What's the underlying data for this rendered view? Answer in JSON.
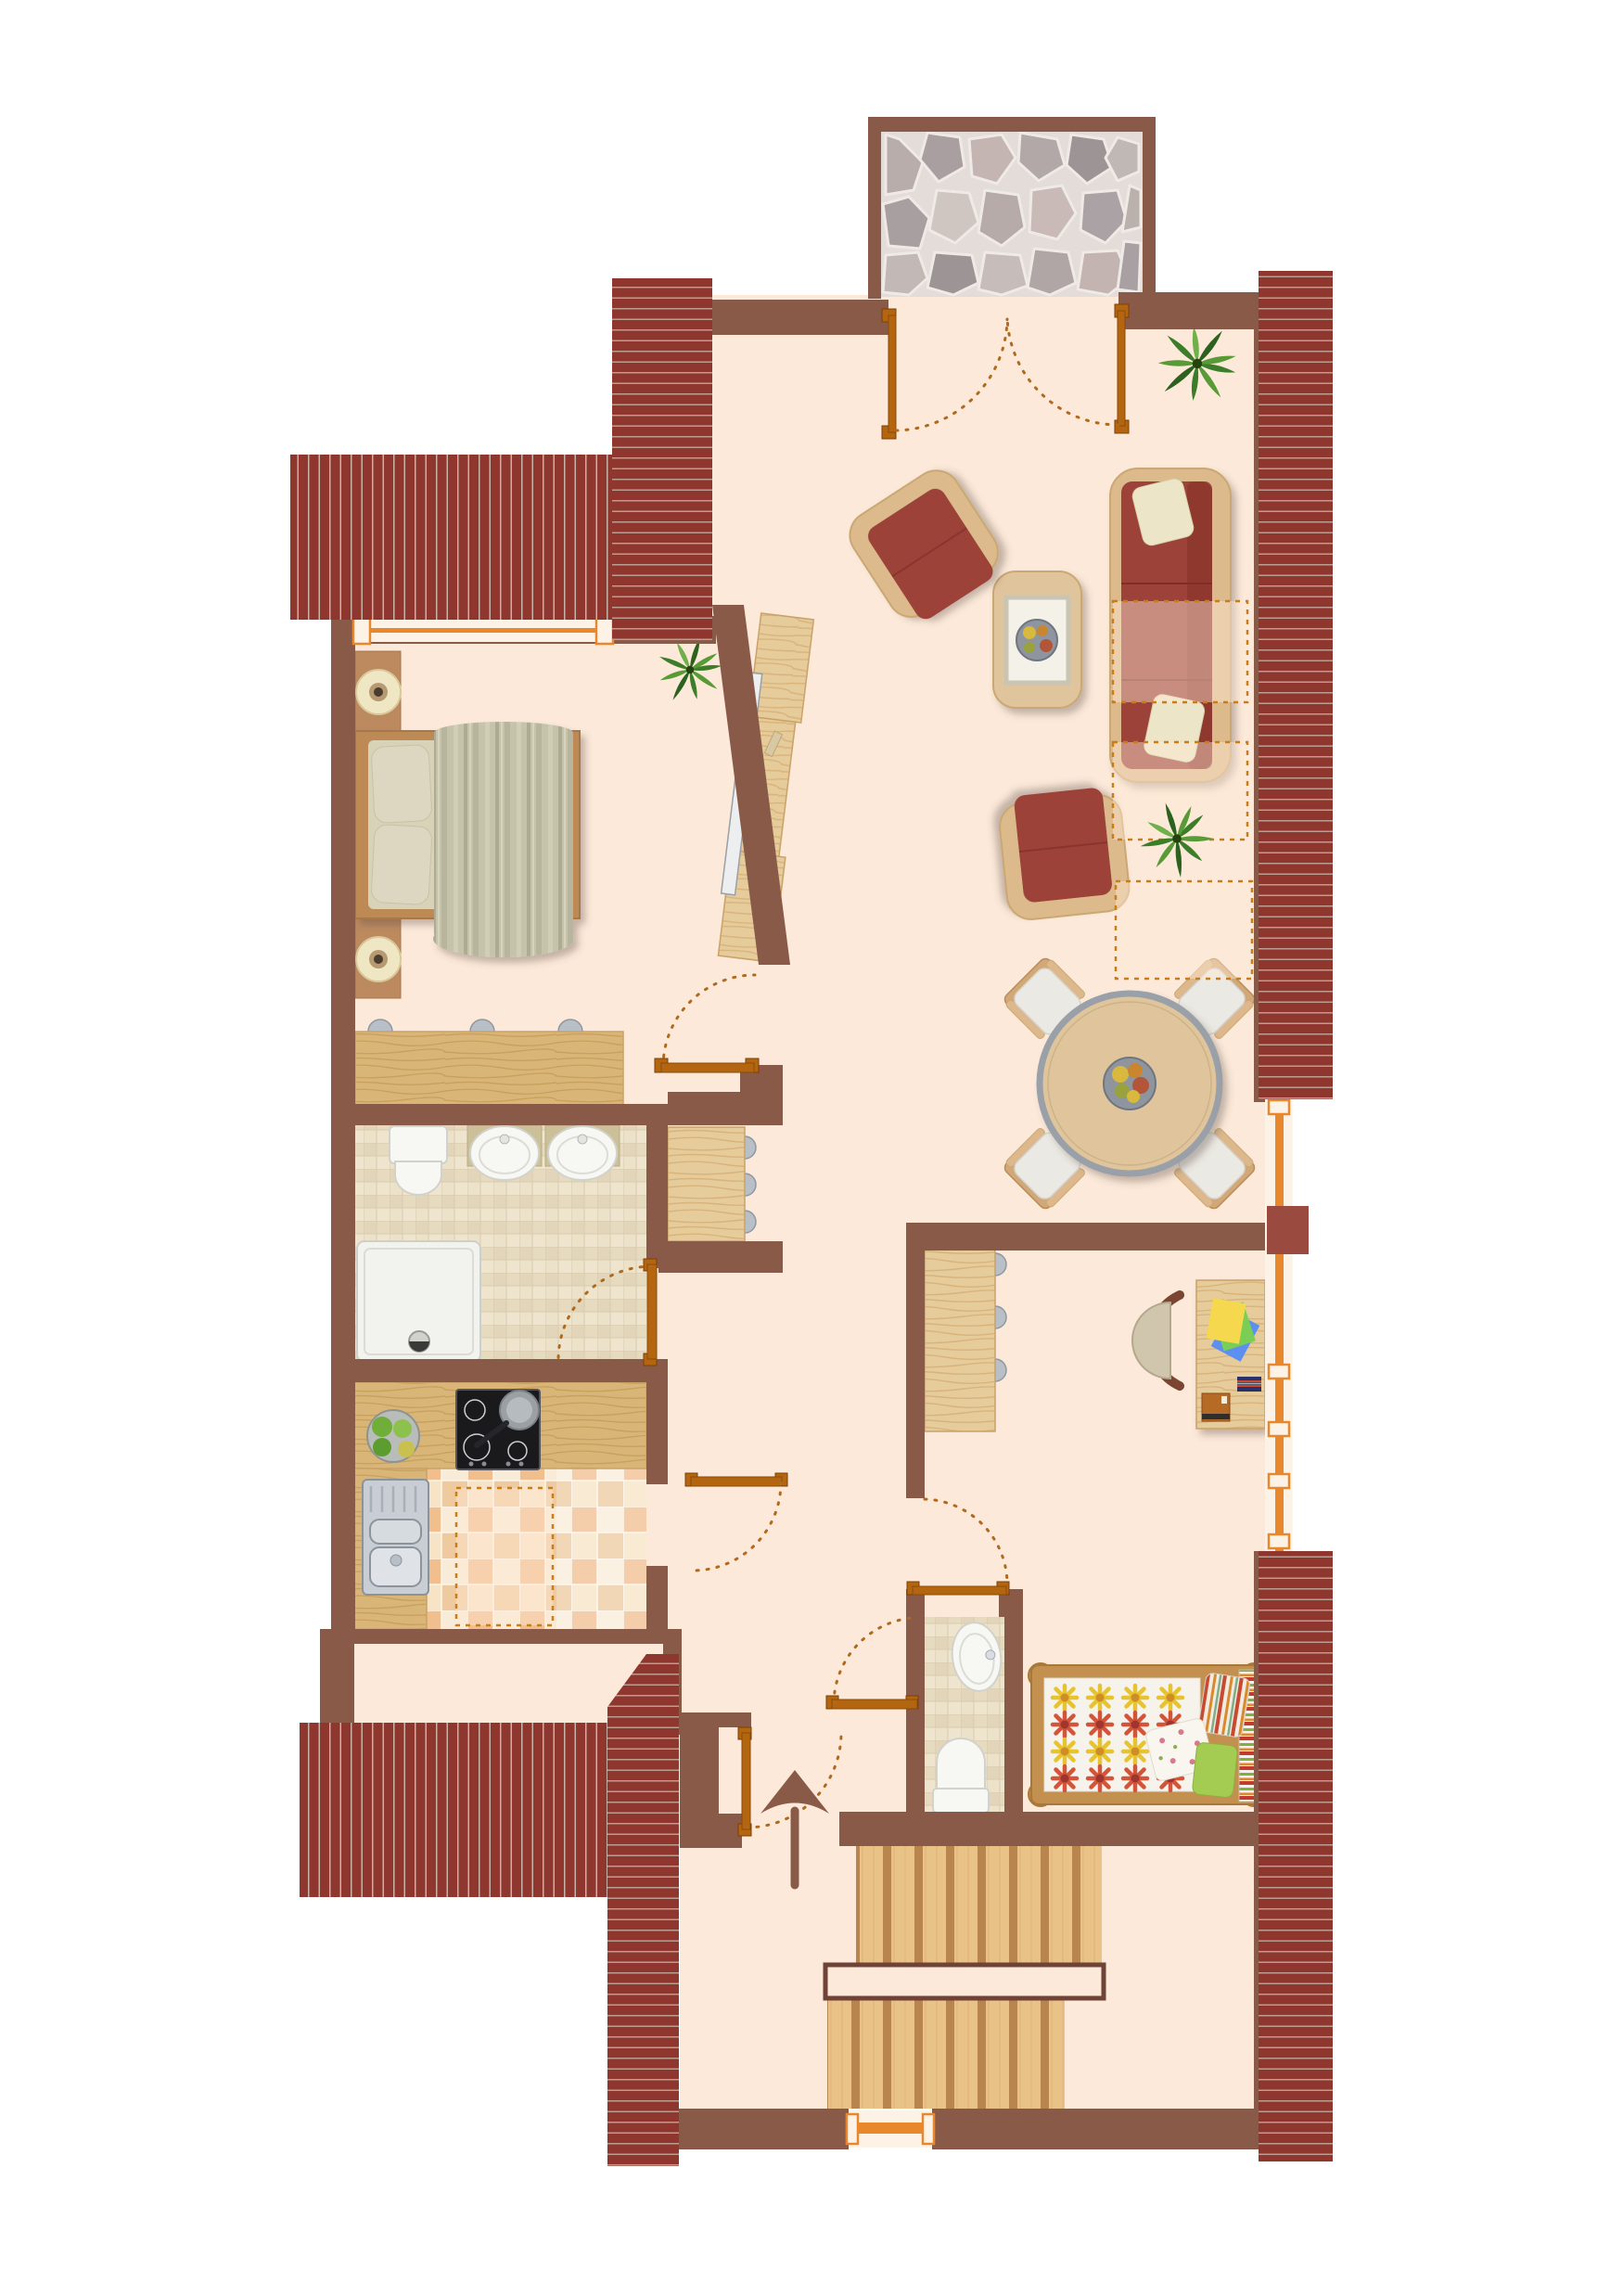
{
  "meta": {
    "title": "Attic apartment floor plan – top view",
    "type": "architectural floor plan",
    "orientation": "entrance and staircase at bottom, balcony at top"
  },
  "palette": {
    "floor": "#fce9d9",
    "wall": "#8a5a49",
    "wallAccent": "#9a4a3e",
    "roofRed": "#8f362f",
    "roofStripeH": "#bb9d92",
    "roofStripeV": "#c6b2a7",
    "windowFrame": "#e8872c",
    "windowSill": "#fdf2e6",
    "doorBar": "#b4650f",
    "doorArc": "#b06a1f",
    "woodLight": "#e6cb9b",
    "woodMid": "#d9b678",
    "woodTable": "#e0c49c",
    "sofaRed": "#9c4237",
    "cushionCream": "#ece5c8",
    "mattressCream": "#d8d2b8",
    "blanketGreen": "#c6c3ab",
    "bathTile": "#e9dec6",
    "kitchenTileOrange": "#f1be8e",
    "kitchenTileCream": "#f8ecd8",
    "stoneGrout": "#e3dcd8",
    "duvetWhite": "#f5f3ec",
    "flowerYellow": "#e7c32f",
    "flowerRed": "#d4543a",
    "plantGreen": "#3c7d2a",
    "stairWood": "#e9c287",
    "stairDivider": "#b9854e"
  },
  "rooms": [
    {
      "id": "balcony",
      "name": "balcony terrace",
      "features": [
        "stone paving",
        "double french door"
      ]
    },
    {
      "id": "living-room",
      "name": "living room",
      "features": [
        "3-seat sofa with 2 cream pillows",
        "2 armchairs",
        "coffee table with fruit bowl",
        "2 potted plants",
        "3 roof-slope markers"
      ]
    },
    {
      "id": "bedroom",
      "name": "bedroom",
      "features": [
        "double bed",
        "2 nightstands with lamps",
        "dresser with 3 knobs",
        "tv sideboard on sloped wall",
        "potted plant",
        "window"
      ]
    },
    {
      "id": "bathroom",
      "name": "bathroom",
      "features": [
        "toilet",
        "two oval washbasins",
        "square shower tray",
        "tiled floor",
        "door"
      ]
    },
    {
      "id": "kitchen",
      "name": "kitchen",
      "features": [
        "L-shaped counter",
        "4-zone cooktop with pan",
        "stainless sink with drainboard",
        "fruit plate",
        "checkered tile floor",
        "roof-slope marker",
        "door"
      ]
    },
    {
      "id": "dining-area",
      "name": "dining area",
      "features": [
        "round table with fruit bowl",
        "4 chairs"
      ]
    },
    {
      "id": "hallway",
      "name": "hallway",
      "features": [
        "wall cabinet with 3 knobs",
        "bedroom door",
        "corridor door"
      ]
    },
    {
      "id": "office-area",
      "name": "office area",
      "features": [
        "desk with papers, books and box",
        "swivel chair",
        "sideboard with 3 knobs",
        "tall window"
      ]
    },
    {
      "id": "wc",
      "name": "guest wc",
      "features": [
        "oval washbasin",
        "toilet",
        "tiled floor",
        "door"
      ]
    },
    {
      "id": "kids-room",
      "name": "kids room",
      "features": [
        "single bed with flower duvet",
        "striped pillow",
        "floral pillow",
        "green pillow",
        "striped blanket roll"
      ]
    },
    {
      "id": "entrance",
      "name": "entrance hall",
      "features": [
        "front door",
        "entry direction arrow"
      ]
    },
    {
      "id": "staircase",
      "name": "staircase",
      "features": [
        "upper flight",
        "landing",
        "lower flight",
        "small window"
      ]
    }
  ],
  "roof_sections": [
    {
      "id": "roof-top-strip",
      "stripes": "horizontal"
    },
    {
      "id": "roof-left-block",
      "stripes": "vertical"
    },
    {
      "id": "roof-right-upper",
      "stripes": "horizontal"
    },
    {
      "id": "roof-right-lower",
      "stripes": "horizontal"
    },
    {
      "id": "roof-bottom-strip",
      "stripes": "horizontal, diagonal top edge"
    },
    {
      "id": "roof-bottom-left-block",
      "stripes": "vertical"
    }
  ],
  "door_count": 8,
  "window_count": 4
}
